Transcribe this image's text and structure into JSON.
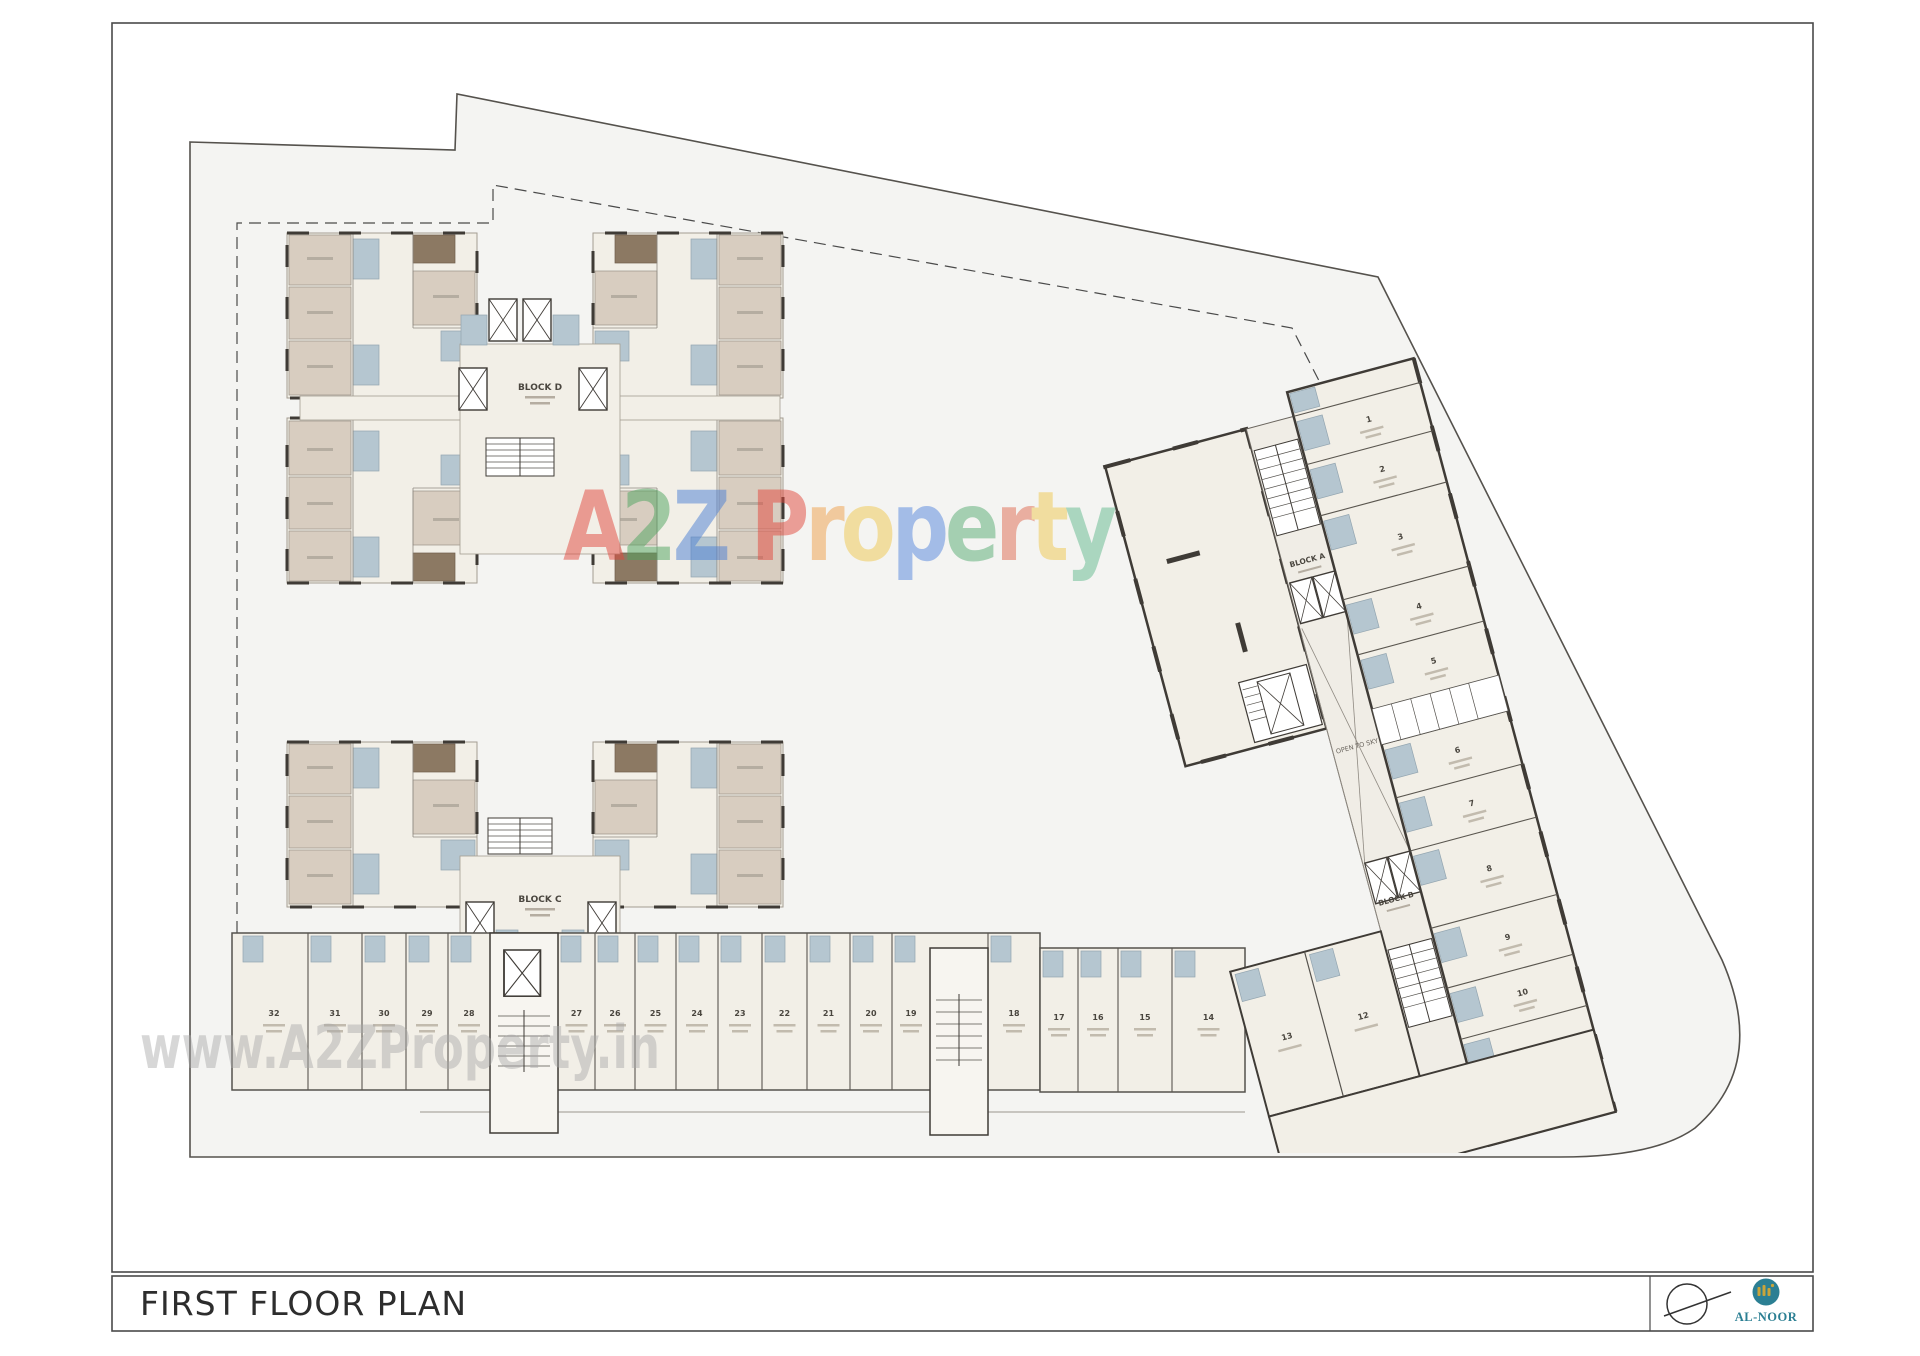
{
  "frame": {
    "title": "FIRST FLOOR PLAN"
  },
  "branding": {
    "logo_text": "AL-NOOR",
    "logo_teal": "#2b7f93",
    "logo_gold": "#c9a43a"
  },
  "watermarks": {
    "center_text": "A2Z Property",
    "center_letters": [
      {
        "ch": "A",
        "color": "#e2483d"
      },
      {
        "ch": "2",
        "color": "#4fa45f"
      },
      {
        "ch": "Z",
        "color": "#4a7fd4"
      },
      {
        "ch": " ",
        "color": "#000000"
      },
      {
        "ch": "P",
        "color": "#e2483d"
      },
      {
        "ch": "r",
        "color": "#f0a04a"
      },
      {
        "ch": "o",
        "color": "#f0c84e"
      },
      {
        "ch": "p",
        "color": "#5585dd"
      },
      {
        "ch": "e",
        "color": "#57ab72"
      },
      {
        "ch": "r",
        "color": "#e06a50"
      },
      {
        "ch": "t",
        "color": "#f0c84e"
      },
      {
        "ch": "y",
        "color": "#62b98e"
      }
    ],
    "bottom_text": "www.A2ZProperty.in"
  },
  "plan": {
    "block_d_label": "BLOCK D",
    "block_c_label": "BLOCK C",
    "block_a_label": "BLOCK A",
    "block_b_label": "BLOCK B",
    "open_to_sky_label": "OPEN TO SKY",
    "row1_units": [
      "32",
      "31",
      "30",
      "29",
      "28",
      "27",
      "26",
      "25",
      "24",
      "23",
      "22",
      "21",
      "20",
      "19",
      "18"
    ],
    "row2_units": [
      "17",
      "16",
      "15",
      "14"
    ],
    "wing_units": [
      "1",
      "2",
      "3",
      "4",
      "5",
      "6",
      "7",
      "8",
      "9",
      "10",
      "11"
    ],
    "bottom_units": [
      "13",
      "12"
    ],
    "colors": {
      "site_fill": "#f4f4f2",
      "floor_cream": "#f2efe7",
      "room_tan": "#d8cdc0",
      "bath_blue": "#b5c6d0",
      "balcony_brown": "#8c7963",
      "wall_dark": "#3f3b36"
    }
  }
}
